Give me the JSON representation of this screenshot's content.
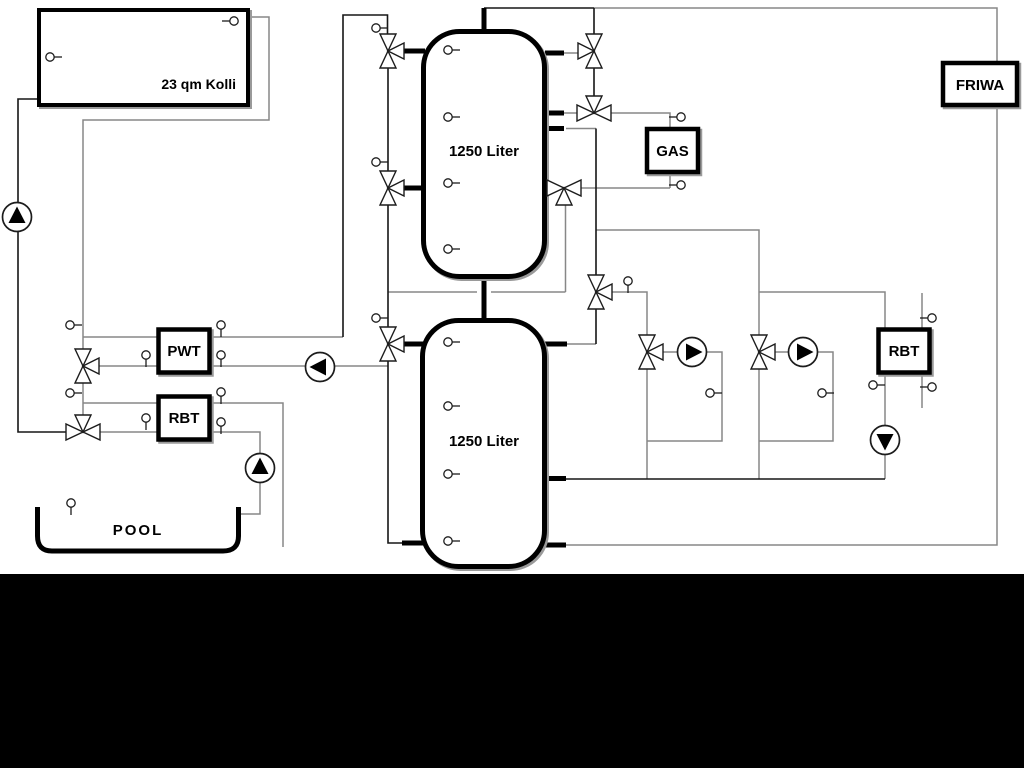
{
  "diagram": {
    "title": "heating-system-hydraulic-schematic",
    "labels": {
      "collector": "23 qm Kolli",
      "tank_top": "1250 Liter",
      "tank_bottom": "1250 Liter",
      "heat_exchanger": "PWT",
      "rbt_left": "RBT",
      "rbt_right": "RBT",
      "gas_boiler": "GAS",
      "fresh_water_station": "FRIWA",
      "pool": "POOL"
    },
    "colors": {
      "background": "#ffffff",
      "footer_bar": "#000000",
      "pipe_dark": "#161616",
      "pipe_gray": "#878787",
      "component_outline": "#000000"
    },
    "components": {
      "tank_count": 2,
      "valve_count": 11,
      "sensor_count": 30,
      "pumps": [
        {
          "name": "solar-pump",
          "flow_direction": "up"
        },
        {
          "name": "pwt-secondary-pump",
          "flow_direction": "left"
        },
        {
          "name": "pool-pump",
          "flow_direction": "up"
        },
        {
          "name": "circuit-1-pump",
          "flow_direction": "right"
        },
        {
          "name": "circuit-2-pump",
          "flow_direction": "right"
        },
        {
          "name": "rbt-right-pump",
          "flow_direction": "down"
        }
      ]
    }
  }
}
